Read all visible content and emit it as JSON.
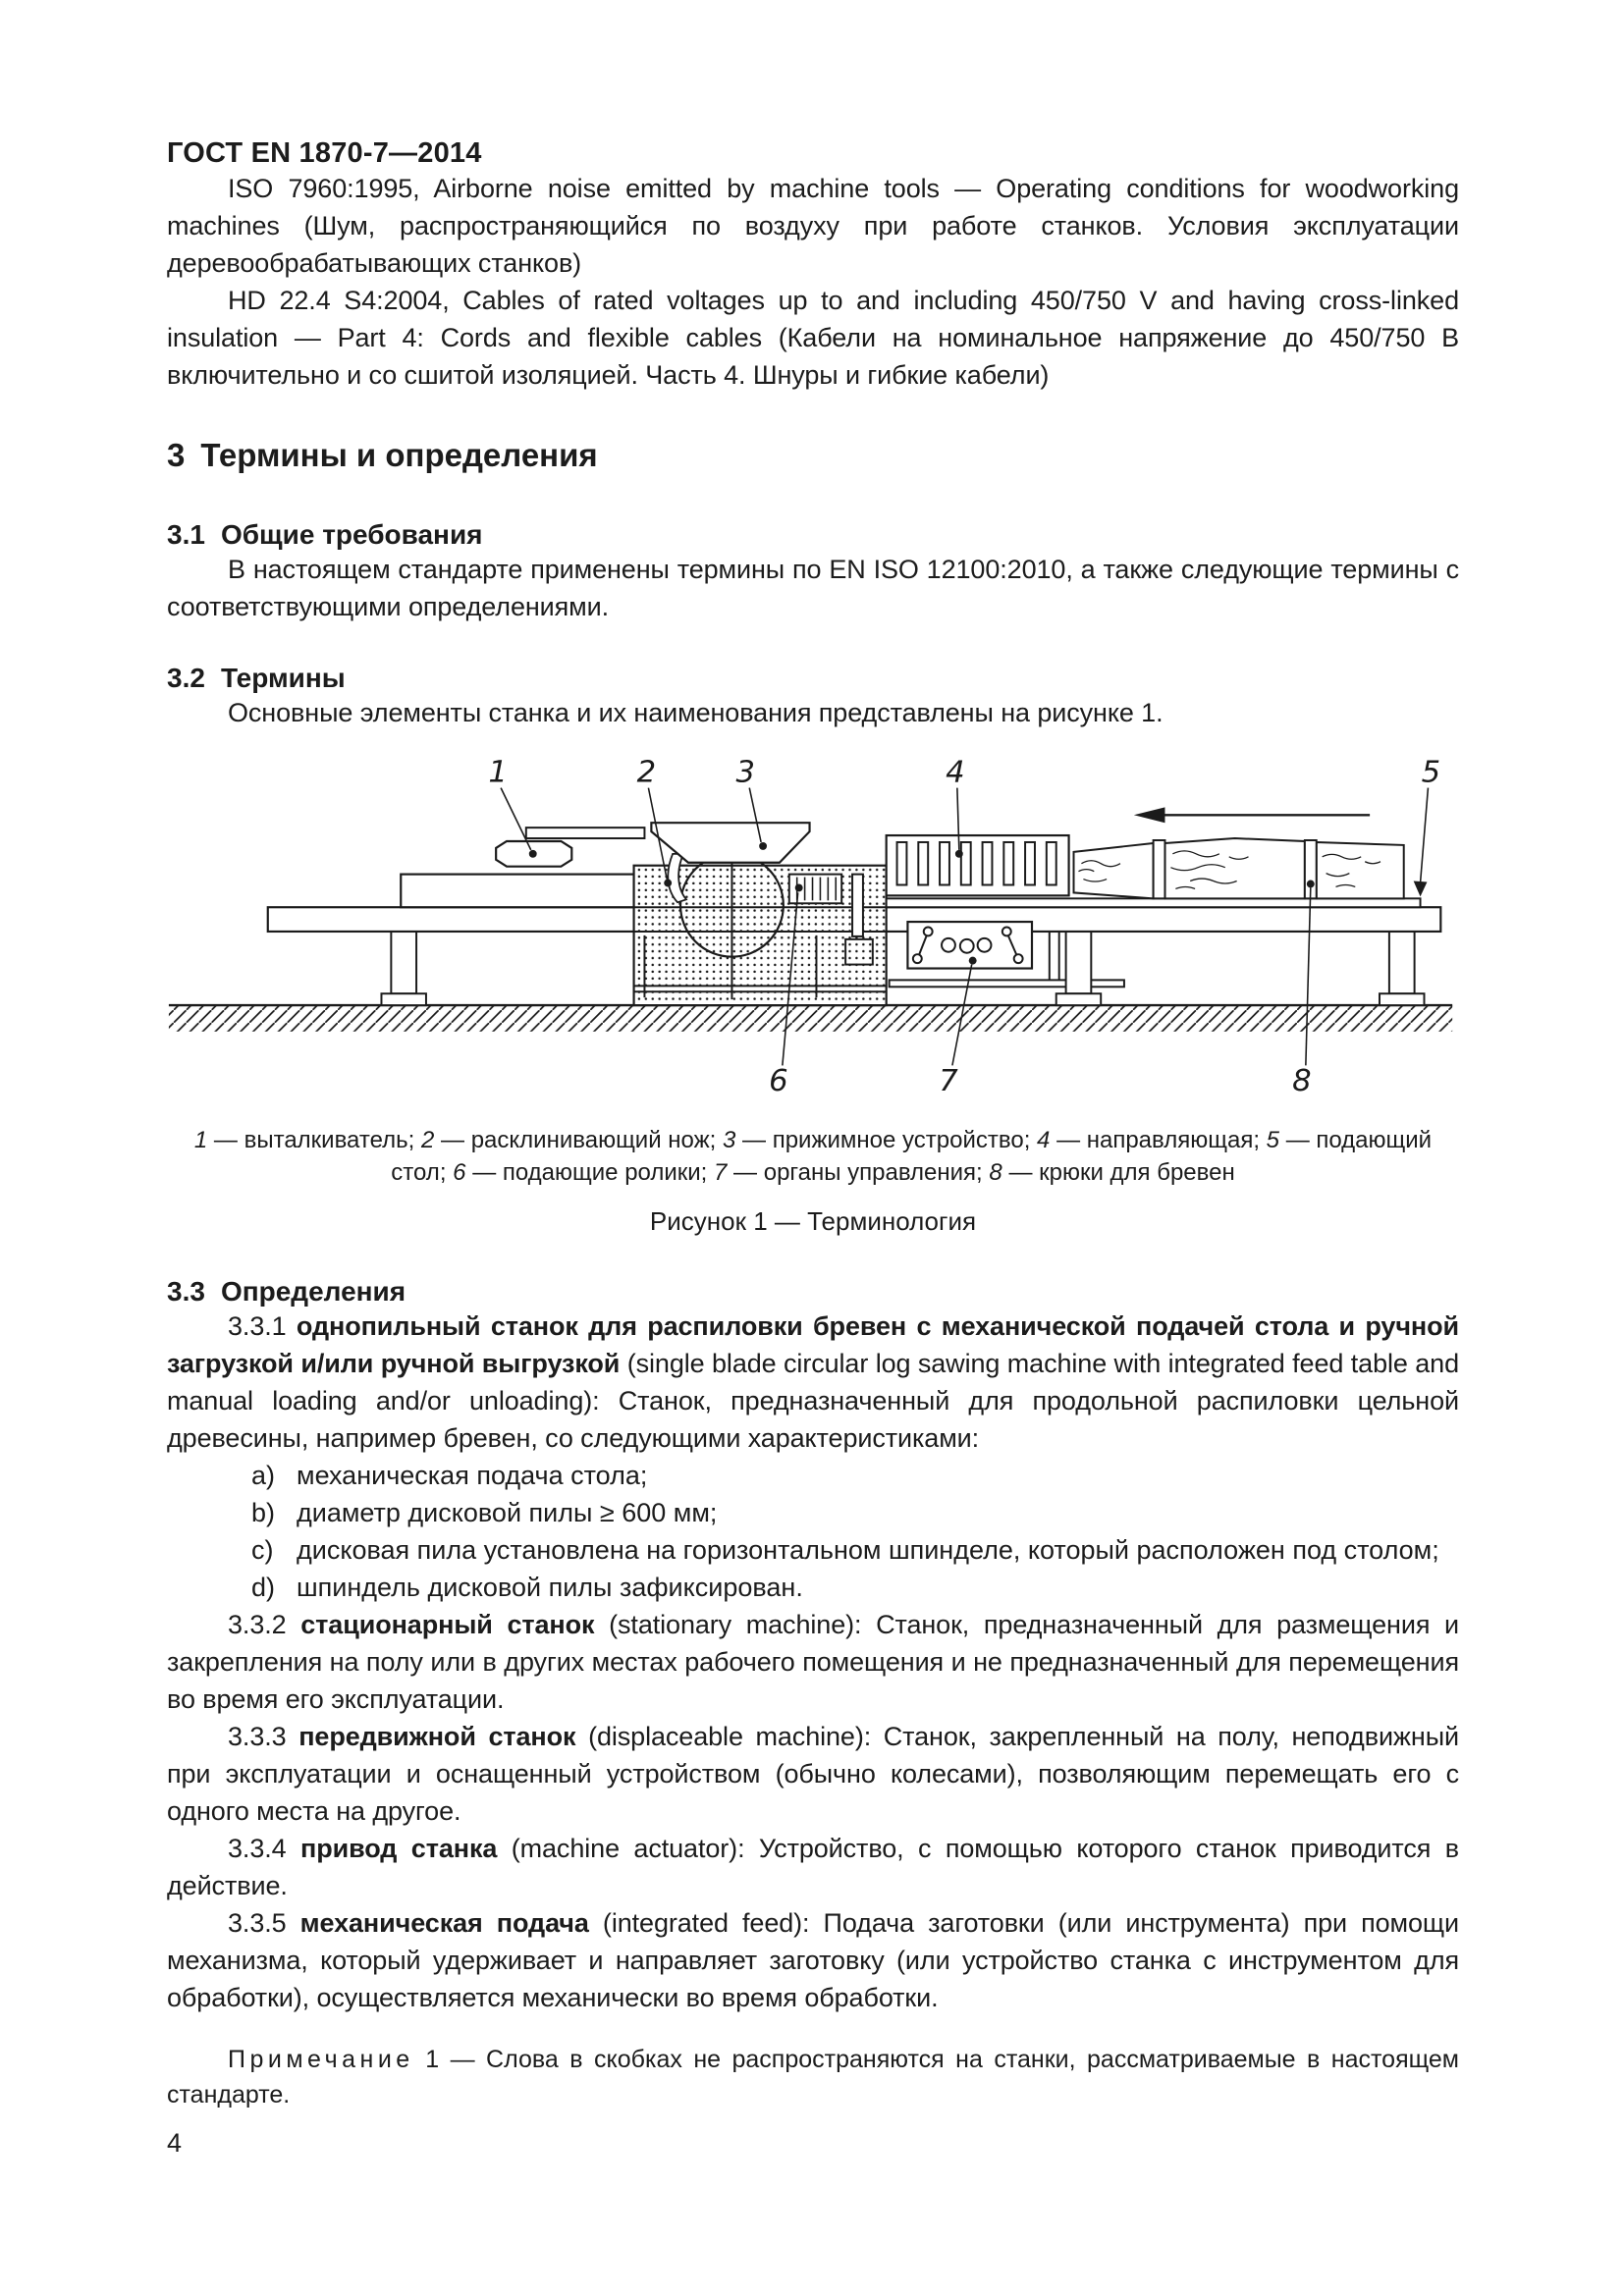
{
  "page": {
    "header": "ГОСТ EN 1870-7—2014",
    "page_number": "4"
  },
  "references": [
    {
      "text": "ISO 7960:1995, Airborne noise emitted by machine tools — Operating conditions for woodworking machines (Шум, распространяющийся по воздуху при работе станков. Условия эксплуатации деревообрабатывающих станков)"
    },
    {
      "text": "HD 22.4 S4:2004, Cables of rated voltages up to and including 450/750 V and having cross-linked insulation — Part 4: Cords and flexible cables (Кабели на номинальное напряжение до 450/750 В включительно и со сшитой изоляцией. Часть 4. Шнуры и гибкие кабели)"
    }
  ],
  "section3": {
    "num": "3",
    "title": "Термины и определения",
    "s31": {
      "num": "3.1",
      "title": "Общие требования",
      "body": "В настоящем стандарте применены термины по EN ISO 12100:2010, а также следующие термины с соответствующими определениями."
    },
    "s32": {
      "num": "3.2",
      "title": "Термины",
      "body": "Основные элементы станка и их наименования представлены на рисунке 1."
    },
    "s33": {
      "num": "3.3",
      "title": "Определения"
    }
  },
  "figure": {
    "callouts": [
      "1",
      "2",
      "3",
      "4",
      "5",
      "6",
      "7",
      "8"
    ],
    "legend": [
      {
        "num": "1",
        "text": "— выталкиватель;"
      },
      {
        "num": "2",
        "text": "— расклинивающий нож;"
      },
      {
        "num": "3",
        "text": "— прижимное устройство;"
      },
      {
        "num": "4",
        "text": "— направляющая;"
      },
      {
        "num": "5",
        "text": "— подающий стол;"
      },
      {
        "num": "6",
        "text": "— подающие ролики;"
      },
      {
        "num": "7",
        "text": "— органы управления;"
      },
      {
        "num": "8",
        "text": "— крюки для бревен"
      }
    ],
    "caption": "Рисунок 1 — Терминология"
  },
  "definitions": [
    {
      "num": "3.3.1",
      "term": "однопильный станок для распиловки бревен с механической подачей стола и ручной загрузкой и/или ручной выгрузкой",
      "rest": "(single blade circular log sawing machine with integrated feed table and manual loading and/or unloading): Станок, предназначенный для продольной распиловки цельной древесины, например бревен, со следующими характеристиками:"
    },
    {
      "num": "3.3.2",
      "term": "стационарный станок",
      "rest": "(stationary machine): Станок, предназначенный для размещения и закрепления на полу или в других местах рабочего помещения и не предназначенный для перемещения во время его эксплуатации."
    },
    {
      "num": "3.3.3",
      "term": "передвижной станок",
      "rest": "(displaceable machine): Станок, закрепленный на полу, неподвижный при эксплуатации и оснащенный устройством (обычно колесами), позволяющим перемещать его с одного места на другое."
    },
    {
      "num": "3.3.4",
      "term": "привод станка",
      "rest": "(machine actuator): Устройство, с помощью которого станок приводится в действие."
    },
    {
      "num": "3.3.5",
      "term": "механическая подача",
      "rest": "(integrated feed): Подача заготовки (или инструмента) при помощи механизма, который удерживает и направляет заготовку (или устройство станка с инструментом для обработки), осуществляется механически во время обработки."
    }
  ],
  "characteristics": [
    {
      "label": "a)",
      "text": "механическая подача стола;"
    },
    {
      "label": "b)",
      "text": "диаметр дисковой пилы ≥ 600 мм;"
    },
    {
      "label": "c)",
      "text": "дисковая пила установлена на горизонтальном шпинделе, который расположен под столом;"
    },
    {
      "label": "d)",
      "text": "шпиндель дисковой пилы зафиксирован."
    }
  ],
  "note": {
    "label": "Примечание",
    "num": "1",
    "text": "— Слова в скобках не распространяются на станки, рассматриваемые в настоящем стандарте."
  }
}
